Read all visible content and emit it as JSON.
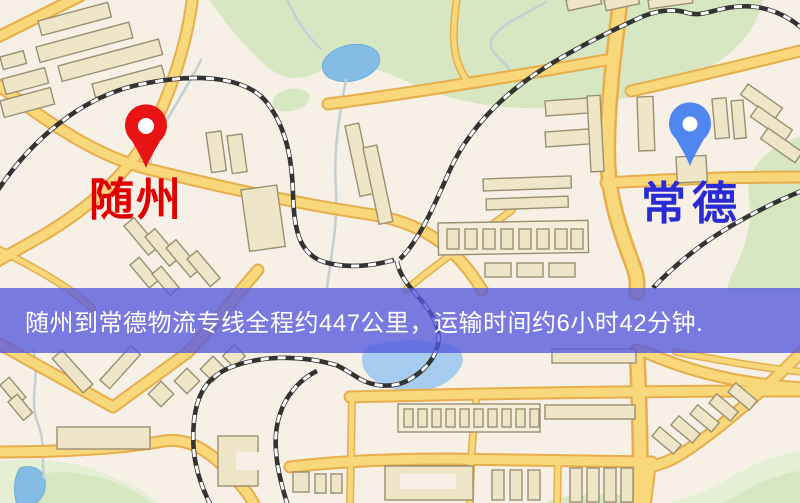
{
  "map": {
    "markers": [
      {
        "id": "suizhou",
        "label": "随州",
        "pin_color": "#e81414",
        "label_color": "#e00000"
      },
      {
        "id": "changde",
        "label": "常德",
        "pin_color": "#4f86ef",
        "label_color": "#2b2bd5"
      }
    ],
    "colors": {
      "background": "#f7f0e6",
      "road_fill": "#f8d87a",
      "road_casing": "#e7ae4b",
      "building_fill": "#efe6c8",
      "building_stroke": "#9b8f72",
      "green": "#d7e7c1",
      "green_light": "#e5efd3",
      "water": "#85bce6",
      "water_light": "#a6cdef",
      "stream": "#c6cfd4",
      "railway": "#333333"
    }
  },
  "banner": {
    "text": "随州到常德物流专线全程约447公里，运输时间约6小时42分钟.",
    "background": "rgba(86,88,222,0.78)",
    "text_color": "#ffffff"
  }
}
